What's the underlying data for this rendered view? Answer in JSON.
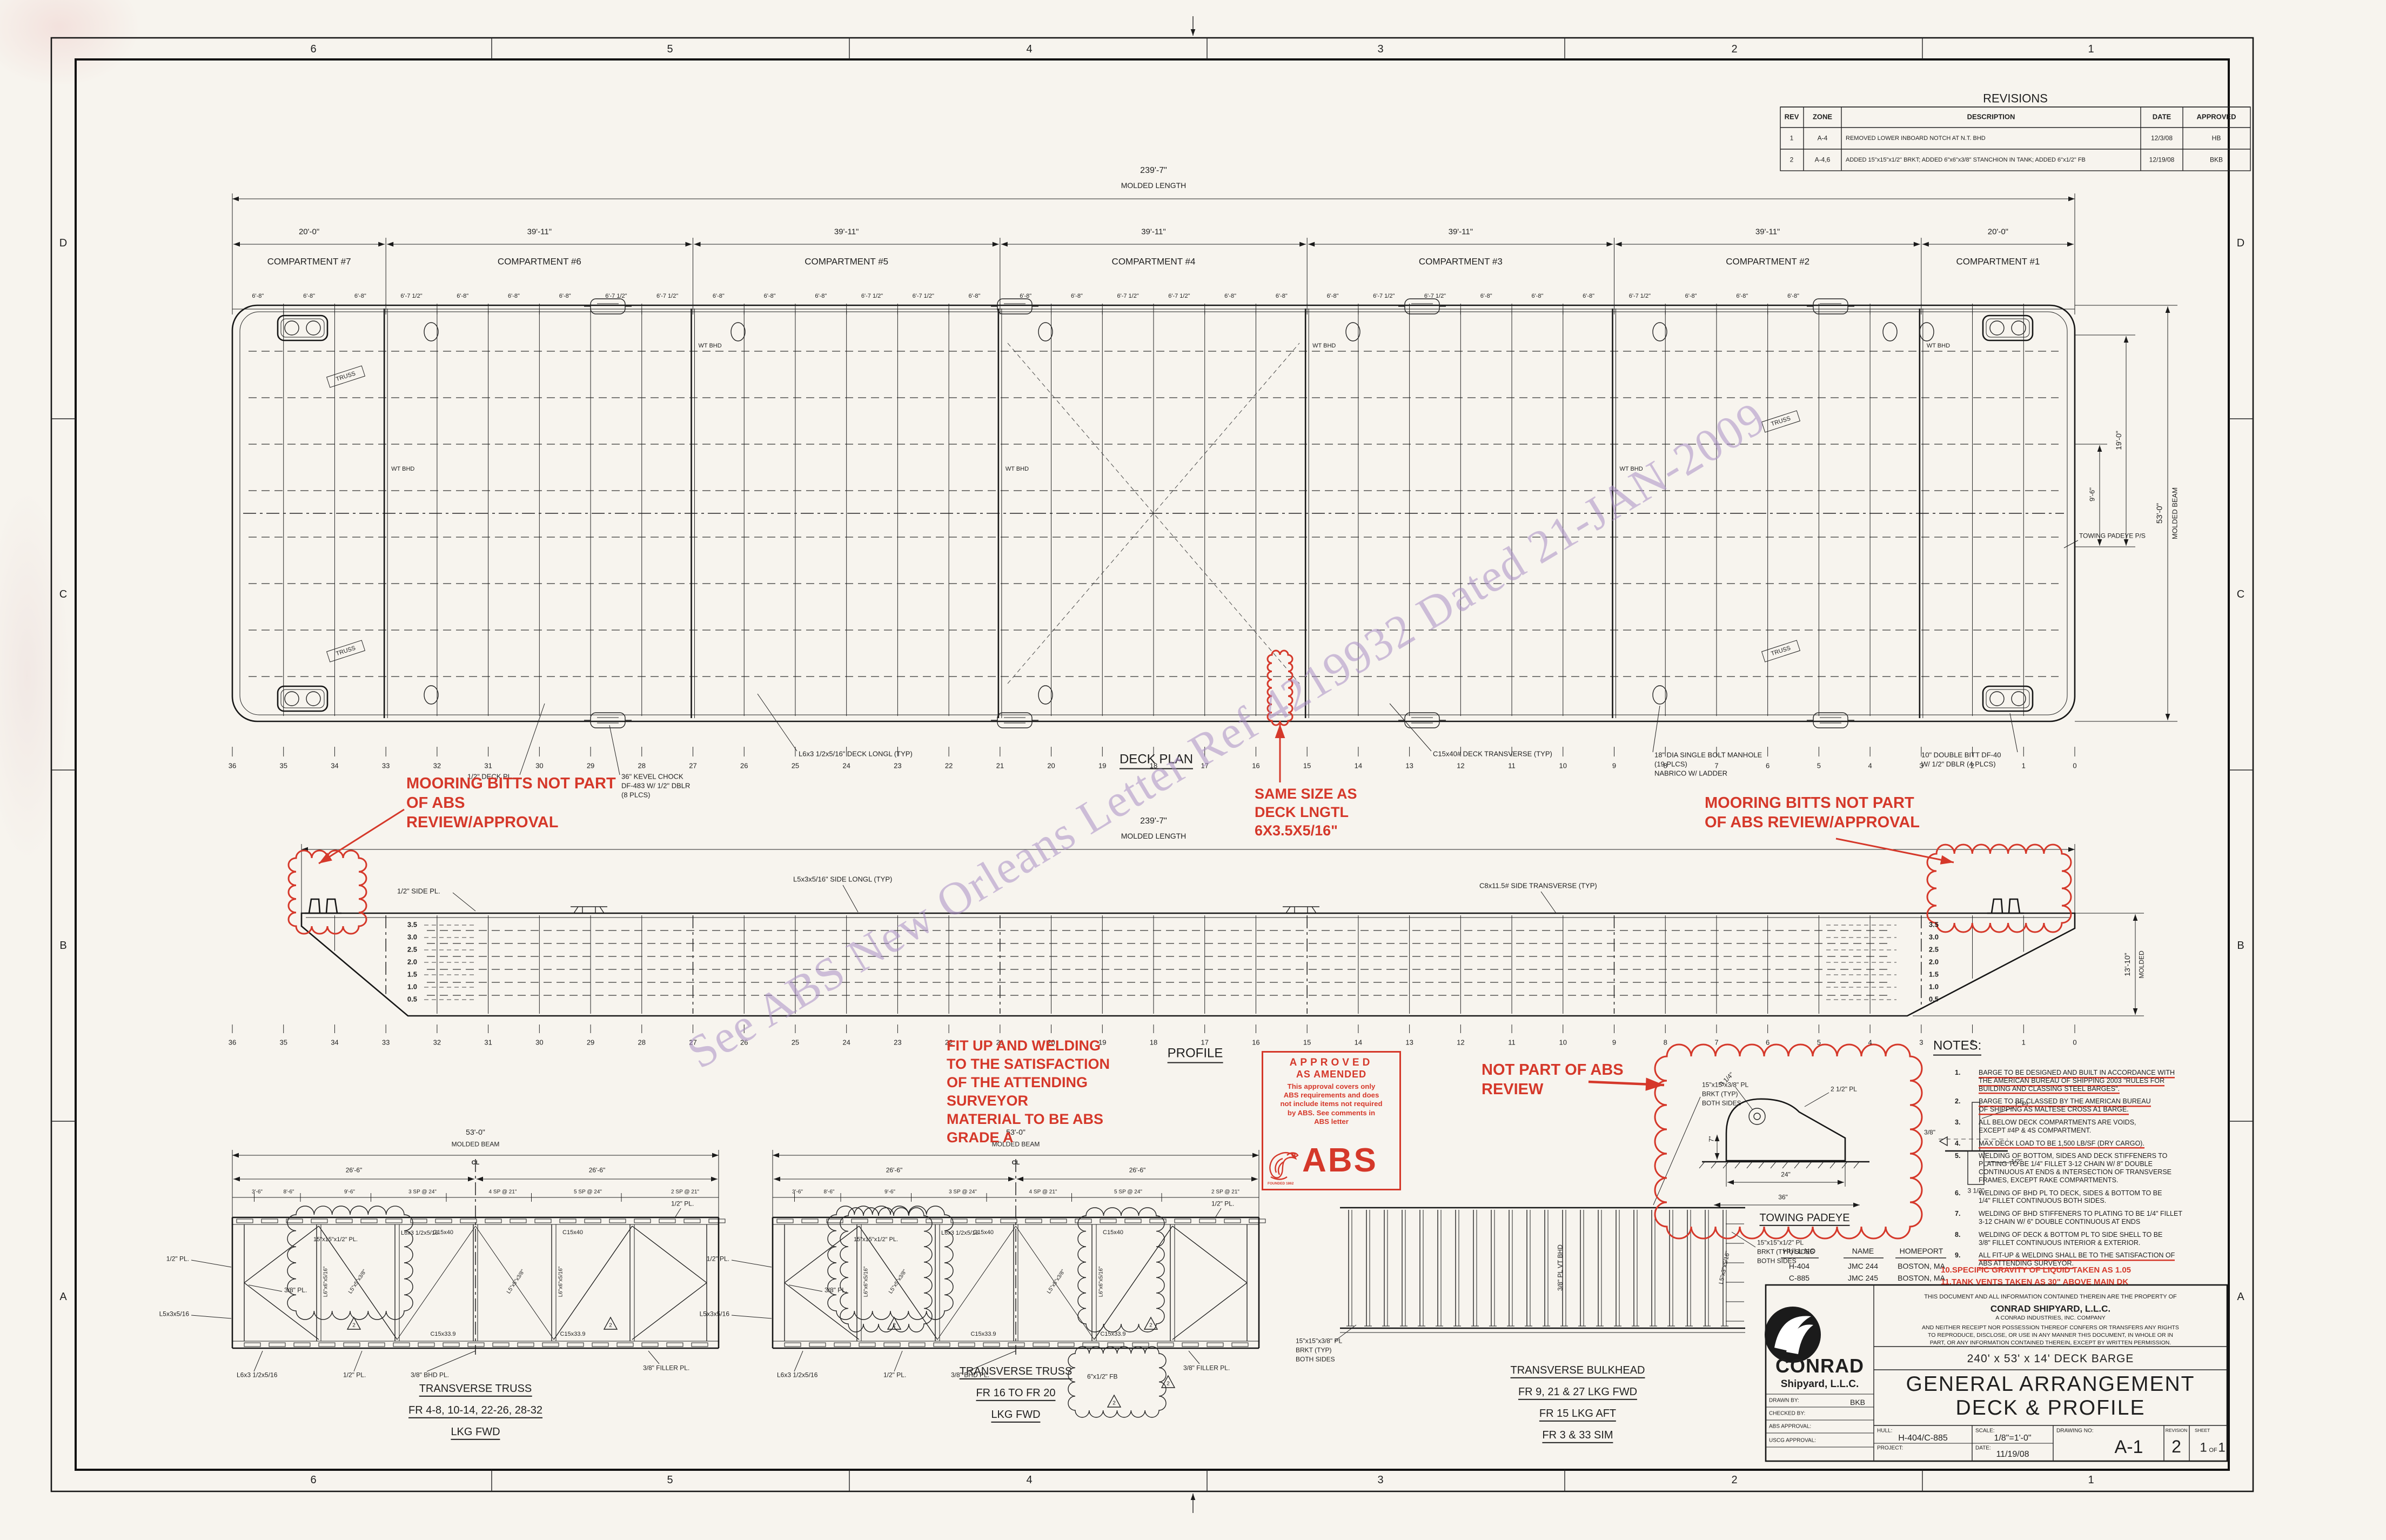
{
  "sheet": {
    "zones_top": [
      "6",
      "5",
      "4",
      "3",
      "2",
      "1"
    ],
    "zones_bottom": [
      "6",
      "5",
      "4",
      "3",
      "2",
      "1"
    ],
    "zones_left": [
      "D",
      "C",
      "B",
      "A"
    ],
    "zones_right": [
      "D",
      "C",
      "B",
      "A"
    ]
  },
  "revisions": {
    "title": "REVISIONS",
    "headers": [
      "REV",
      "ZONE",
      "DESCRIPTION",
      "DATE",
      "APPROVED"
    ],
    "rows": [
      {
        "rev": "1",
        "zone": "A-4",
        "description": "REMOVED LOWER INBOARD NOTCH AT N.T. BHD",
        "date": "12/3/08",
        "approved": "HB"
      },
      {
        "rev": "2",
        "zone": "A-4,6",
        "description": "ADDED 15\"x15\"x1/2\" BRKT; ADDED 6\"x6\"x3/8\" STANCHION IN TANK; ADDED 6\"x1/2\" FB",
        "date": "12/19/08",
        "approved": "BKB"
      }
    ]
  },
  "deck_plan": {
    "title": "DECK PLAN",
    "length_dim": "239'-7\"",
    "length_label": "MOLDED LENGTH",
    "beam_dim": "53'-0\"",
    "beam_label": "MOLDED BEAM",
    "dim_19": "19'-0\"",
    "dim_9_6": "9'-6\"",
    "compartments": [
      {
        "name": "COMPARTMENT #7",
        "dim": "20'-0\""
      },
      {
        "name": "COMPARTMENT #6",
        "dim": "39'-11\""
      },
      {
        "name": "COMPARTMENT #5",
        "dim": "39'-11\""
      },
      {
        "name": "COMPARTMENT #4",
        "dim": "39'-11\""
      },
      {
        "name": "COMPARTMENT #3",
        "dim": "39'-11\""
      },
      {
        "name": "COMPARTMENT #2",
        "dim": "39'-11\""
      },
      {
        "name": "COMPARTMENT #1",
        "dim": "20'-0\""
      }
    ],
    "spacing_end": [
      "6'-8\"",
      "6'-8\"",
      "6'-8\""
    ],
    "spacing_mid": [
      "6'-7 1/2\"",
      "6'-8\"",
      "6'-8\"",
      "6'-8\"",
      "6'-7 1/2\""
    ],
    "frame_numbers": [
      "36",
      "35",
      "34",
      "33",
      "32",
      "31",
      "30",
      "29",
      "28",
      "27",
      "26",
      "25",
      "24",
      "23",
      "22",
      "21",
      "20",
      "19",
      "18",
      "17",
      "16",
      "15",
      "14",
      "13",
      "12",
      "11",
      "10",
      "9",
      "8",
      "7",
      "6",
      "5",
      "4",
      "3",
      "2",
      "1",
      "0"
    ],
    "wt_bhd": "WT BHD",
    "truss": "TRUSS",
    "towing_padeye": "TOWING PADEYE P/S",
    "callouts": {
      "deck_pl": [
        "1/2\" DECK PL."
      ],
      "kevel": [
        "36\" KEVEL CHOCK",
        "DF-483 W/ 1/2\" DBLR",
        "(8 PLCS)"
      ],
      "deck_longl": [
        "L6x3 1/2x5/16\" DECK LONGL (TYP)"
      ],
      "deck_transverse": [
        "C15x40# DECK TRANSVERSE (TYP)"
      ],
      "manhole": [
        "18\" DIA SINGLE BOLT MANHOLE",
        "(19 PLCS)",
        "NABRICO W/ LADDER"
      ],
      "double_bitt": [
        "10\" DOUBLE BITT DF-40",
        "W/ 1/2\" DBLR (4 PLCS)"
      ]
    }
  },
  "profile": {
    "title": "PROFILE",
    "length_dim": "239'-7\"",
    "length_label": "MOLDED LENGTH",
    "depth_dim": "13'-10\"",
    "depth_label": "MOLDED",
    "draft_marks": [
      "3.5",
      "3.0",
      "2.5",
      "2.0",
      "1.5",
      "1.0",
      "0.5"
    ],
    "callouts": {
      "side_pl": [
        "1/2\" SIDE PL."
      ],
      "side_longl": [
        "L5x3x5/16\" SIDE LONGL (TYP)"
      ],
      "side_transverse": [
        "C8x11.5# SIDE TRANSVERSE (TYP)"
      ]
    }
  },
  "annotations": {
    "mooring_left": [
      "MOORING BITTS NOT PART",
      "OF ABS",
      "REVIEW/APPROVAL"
    ],
    "mooring_right": [
      "MOORING BITTS NOT PART",
      "OF ABS REVIEW/APPROVAL"
    ],
    "same_size": [
      "SAME SIZE AS",
      "DECK LNGTL",
      "6X3.5X5/16\""
    ],
    "fit_up": [
      "FIT UP AND WELDING",
      "TO THE SATISFACTION",
      "OF THE ATTENDING",
      "SURVEYOR",
      "MATERIAL TO BE ABS",
      "GRADE A"
    ],
    "not_part": [
      "NOT PART OF ABS",
      "REVIEW"
    ]
  },
  "stamp": {
    "line1": "APPROVED",
    "line2": "AS AMENDED",
    "body": [
      "This approval covers only",
      "ABS requirements and does",
      "not include items not required",
      "by ABS. See comments in",
      "ABS letter"
    ],
    "logo": "ABS",
    "founded": "FOUNDED 1862"
  },
  "watermark": {
    "text": "See ABS New Orleans Letter Ref 4219932 Dated 21-JAN-2009"
  },
  "notes": {
    "title": "NOTES:",
    "items": [
      {
        "n": "1.",
        "rul": true,
        "lines": [
          "BARGE TO BE DESIGNED AND BUILT IN ACCORDANCE WITH",
          "THE AMERICAN BUREAU OF SHIPPING 2003 \"RULES FOR",
          "BUILDING AND CLASSING STEEL BARGES\"."
        ]
      },
      {
        "n": "2.",
        "rul": true,
        "lines": [
          "BARGE TO BE CLASSED BY THE AMERICAN BUREAU",
          "OF SHIPPING AS MALTESE CROSS A1 BARGE."
        ]
      },
      {
        "n": "3.",
        "rul": false,
        "lines": [
          "ALL BELOW DECK COMPARTMENTS ARE VOIDS,",
          "EXCEPT #4P & 4S COMPARTMENT."
        ]
      },
      {
        "n": "4.",
        "rul": true,
        "lines": [
          "MAX DECK LOAD TO BE 1,500 LB/SF (DRY CARGO)."
        ]
      },
      {
        "n": "5.",
        "rul": false,
        "lines": [
          "WELDING OF BOTTOM, SIDES AND DECK STIFFENERS TO",
          "PLATING TO BE 1/4\" FILLET 3-12 CHAIN W/ 8\" DOUBLE",
          "CONTINUOUS AT ENDS & INTERSECTION OF TRANSVERSE",
          "FRAMES, EXCEPT RAKE COMPARTMENTS."
        ]
      },
      {
        "n": "6.",
        "rul": false,
        "lines": [
          "WELDING OF BHD PL TO DECK, SIDES & BOTTOM TO BE",
          "1/4\" FILLET CONTINUOUS BOTH SIDES."
        ]
      },
      {
        "n": "7.",
        "rul": false,
        "lines": [
          "WELDING OF BHD STIFFENERS TO PLATING TO BE 1/4\" FILLET",
          "3-12 CHAIN W/ 6\" DOUBLE CONTINUOUS AT ENDS"
        ]
      },
      {
        "n": "8.",
        "rul": false,
        "lines": [
          "WELDING OF DECK & BOTTOM PL TO SIDE SHELL TO BE",
          "3/8\" FILLET CONTINUOUS INTERIOR & EXTERIOR."
        ]
      },
      {
        "n": "9.",
        "rul": true,
        "lines": [
          "ALL FIT-UP & WELDING SHALL BE TO THE SATISFACTION OF",
          "ABS ATTENDING SURVEYOR."
        ]
      }
    ],
    "red_items": [
      {
        "text": "10.SPECIFIC GRAVITY OF LIQUID TAKEN AS 1.05"
      },
      {
        "text": "11.TANK VENTS TAKEN AS 30\" ABOVE MAIN DK"
      }
    ]
  },
  "hull_table": {
    "headers": [
      "HULL NO",
      "NAME",
      "HOMEPORT"
    ],
    "rows": [
      [
        "H-404",
        "JMC 244",
        "BOSTON, MA"
      ],
      [
        "C-885",
        "JMC 245",
        "BOSTON, MA"
      ]
    ]
  },
  "title_block": {
    "company_name": "CONRAD",
    "company_sub": "Shipyard, L.L.C.",
    "property": [
      "THIS DOCUMENT AND ALL INFORMATION CONTAINED THEREIN ARE THE PROPERTY OF",
      "CONRAD SHIPYARD, L.L.C.",
      "A CONRAD INDUSTRIES, INC. COMPANY",
      "AND NEITHER RECEIPT NOR POSSESSION THEREOF CONFERS OR TRANSFERS ANY RIGHTS",
      "TO REPRODUCE, DISCLOSE, OR USE IN ANY MANNER THIS DOCUMENT, IN WHOLE OR IN",
      "PART, OR ANY INFORMATION CONTAINED THEREIN, EXCEPT BY WRITTEN PERMISSION."
    ],
    "subtitle": "240' x 53' x 14' DECK BARGE",
    "title_line1": "GENERAL ARRANGEMENT",
    "title_line2": "DECK & PROFILE",
    "fields": {
      "drawn_by_label": "DRAWN BY:",
      "drawn_by": "BKB",
      "checked_by_label": "CHECKED BY:",
      "abs_approval_label": "ABS APPROVAL:",
      "uscg_approval_label": "USCG APPROVAL:",
      "hull_label": "HULL:",
      "hull": "H-404/C-885",
      "project_label": "PROJECT:",
      "scale_label": "SCALE:",
      "scale": "1/8\"=1'-0\"",
      "date_label": "DATE:",
      "date": "11/19/08",
      "drawing_no_label": "DRAWING NO:",
      "drawing_no": "A-1",
      "revision_label": "REVISION",
      "revision": "2",
      "sheet_label": "SHEET",
      "sheet": "1",
      "of": "OF",
      "sheet_total": "1"
    }
  },
  "details": {
    "truss_shared": {
      "beam_dim": "53'-0\"",
      "beam_label": "MOLDED BEAM",
      "cl": "CL",
      "half_dim": "26'-6\"",
      "spacing": [
        "3'-6\"",
        "8'-6\"",
        "9'-6\"",
        "3 SP @ 24\"",
        "4 SP @ 21\"",
        "5 SP @ 24\"",
        "2 SP @ 21\""
      ],
      "members": {
        "top_chord": "C15x40",
        "bottom_chord": "C15x33.9",
        "brkt": "15\"x15\"x1/2\" PL.",
        "longl": "L6x3 1/2x5/16",
        "pl_half": "1/2\" PL.",
        "pl_38": "3/8\" PL.",
        "l5": "L5x3x5/16",
        "bhd_pl": "3/8\" BHD PL.",
        "filler": "3/8\" FILLER PL.",
        "diag1": "L5\"x5\"x3/8\"",
        "diag2": "L6\"x6\"x5/16\"",
        "fb": "6\"x1/2\" FB"
      }
    },
    "truss1": {
      "caption": [
        "TRANSVERSE TRUSS",
        "FR 4-8, 10-14, 22-26, 28-32",
        "LKG FWD"
      ]
    },
    "truss2": {
      "caption": [
        "TRANSVERSE TRUSS",
        "FR 16 TO FR 20",
        "LKG FWD"
      ]
    },
    "bulkhead": {
      "caption": [
        "TRANSVERSE BULKHEAD",
        "FR 9, 21 & 27 LKG FWD",
        "FR 15 LKG AFT",
        "FR 3 & 33 SIM"
      ],
      "vt_bhd": "3/8\" PL VT BHD",
      "stiffener": "L5\"x3\"x5/16\"",
      "bracket_note_top": [
        "15\"x15\"x3/8\" PL",
        "BRKT (TYP)",
        "BOTH SIDES"
      ],
      "bracket_note_left": [
        "15\"x15\"x3/8\" PL",
        "BRKT (TYP)",
        "BOTH SIDES"
      ],
      "bracket_note_right": [
        "15\"x15\"x1/2\" PL",
        "BRKT (TYP) SIDES",
        "BOTH SIDES"
      ]
    },
    "padeye": {
      "caption": "TOWING PADEYE",
      "labels": {
        "pl": "2 1/2\" PL",
        "dim314": "3 1/4\"",
        "dim7": "7\"",
        "dim24": "24\"",
        "dim36": "36\"",
        "pl1": "1\" PL",
        "w38": "3/8\"",
        "t12": "1/2\"",
        "d312": "3 1/2\""
      }
    }
  }
}
